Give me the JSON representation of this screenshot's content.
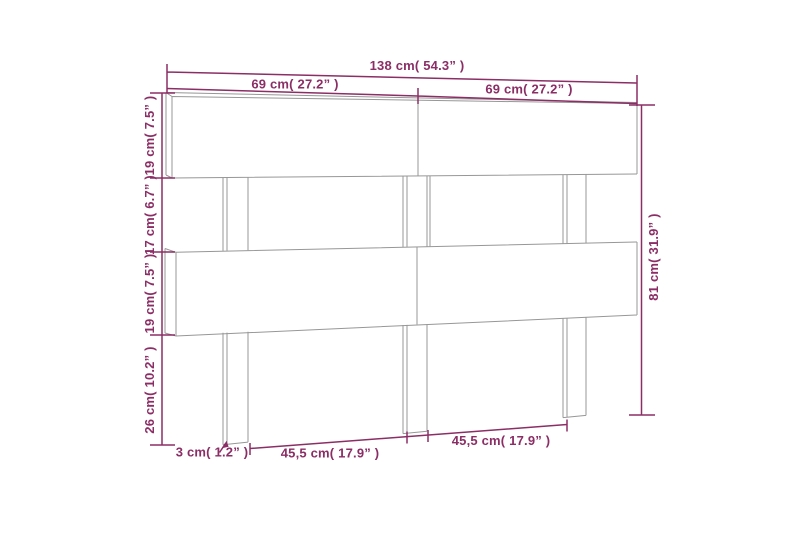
{
  "diagram": {
    "type": "product-dimension-diagram",
    "subject": "slatted wooden headboard, front 3/4 perspective line drawing",
    "colors": {
      "dimension_annotations": "#8b2e66",
      "product_outline": "#979797",
      "background": "#ffffff"
    },
    "labels": {
      "total_width": "138 cm( 54.3” )",
      "left_section_width": "69 cm( 27.2” )",
      "right_section_width": "69 cm( 27.2” )",
      "top_board_height": "19 cm( 7.5” )",
      "middle_gap_height": "17 cm( 6.7” )",
      "middle_board_height": "19 cm( 7.5” )",
      "lower_leg_height": "26 cm( 10.2” )",
      "total_height": "81 cm( 31.9” )",
      "leg_width": "3 cm( 1.2” )",
      "left_leg_span": "45,5 cm( 17.9” )",
      "right_leg_span": "45,5 cm( 17.9” )"
    }
  }
}
